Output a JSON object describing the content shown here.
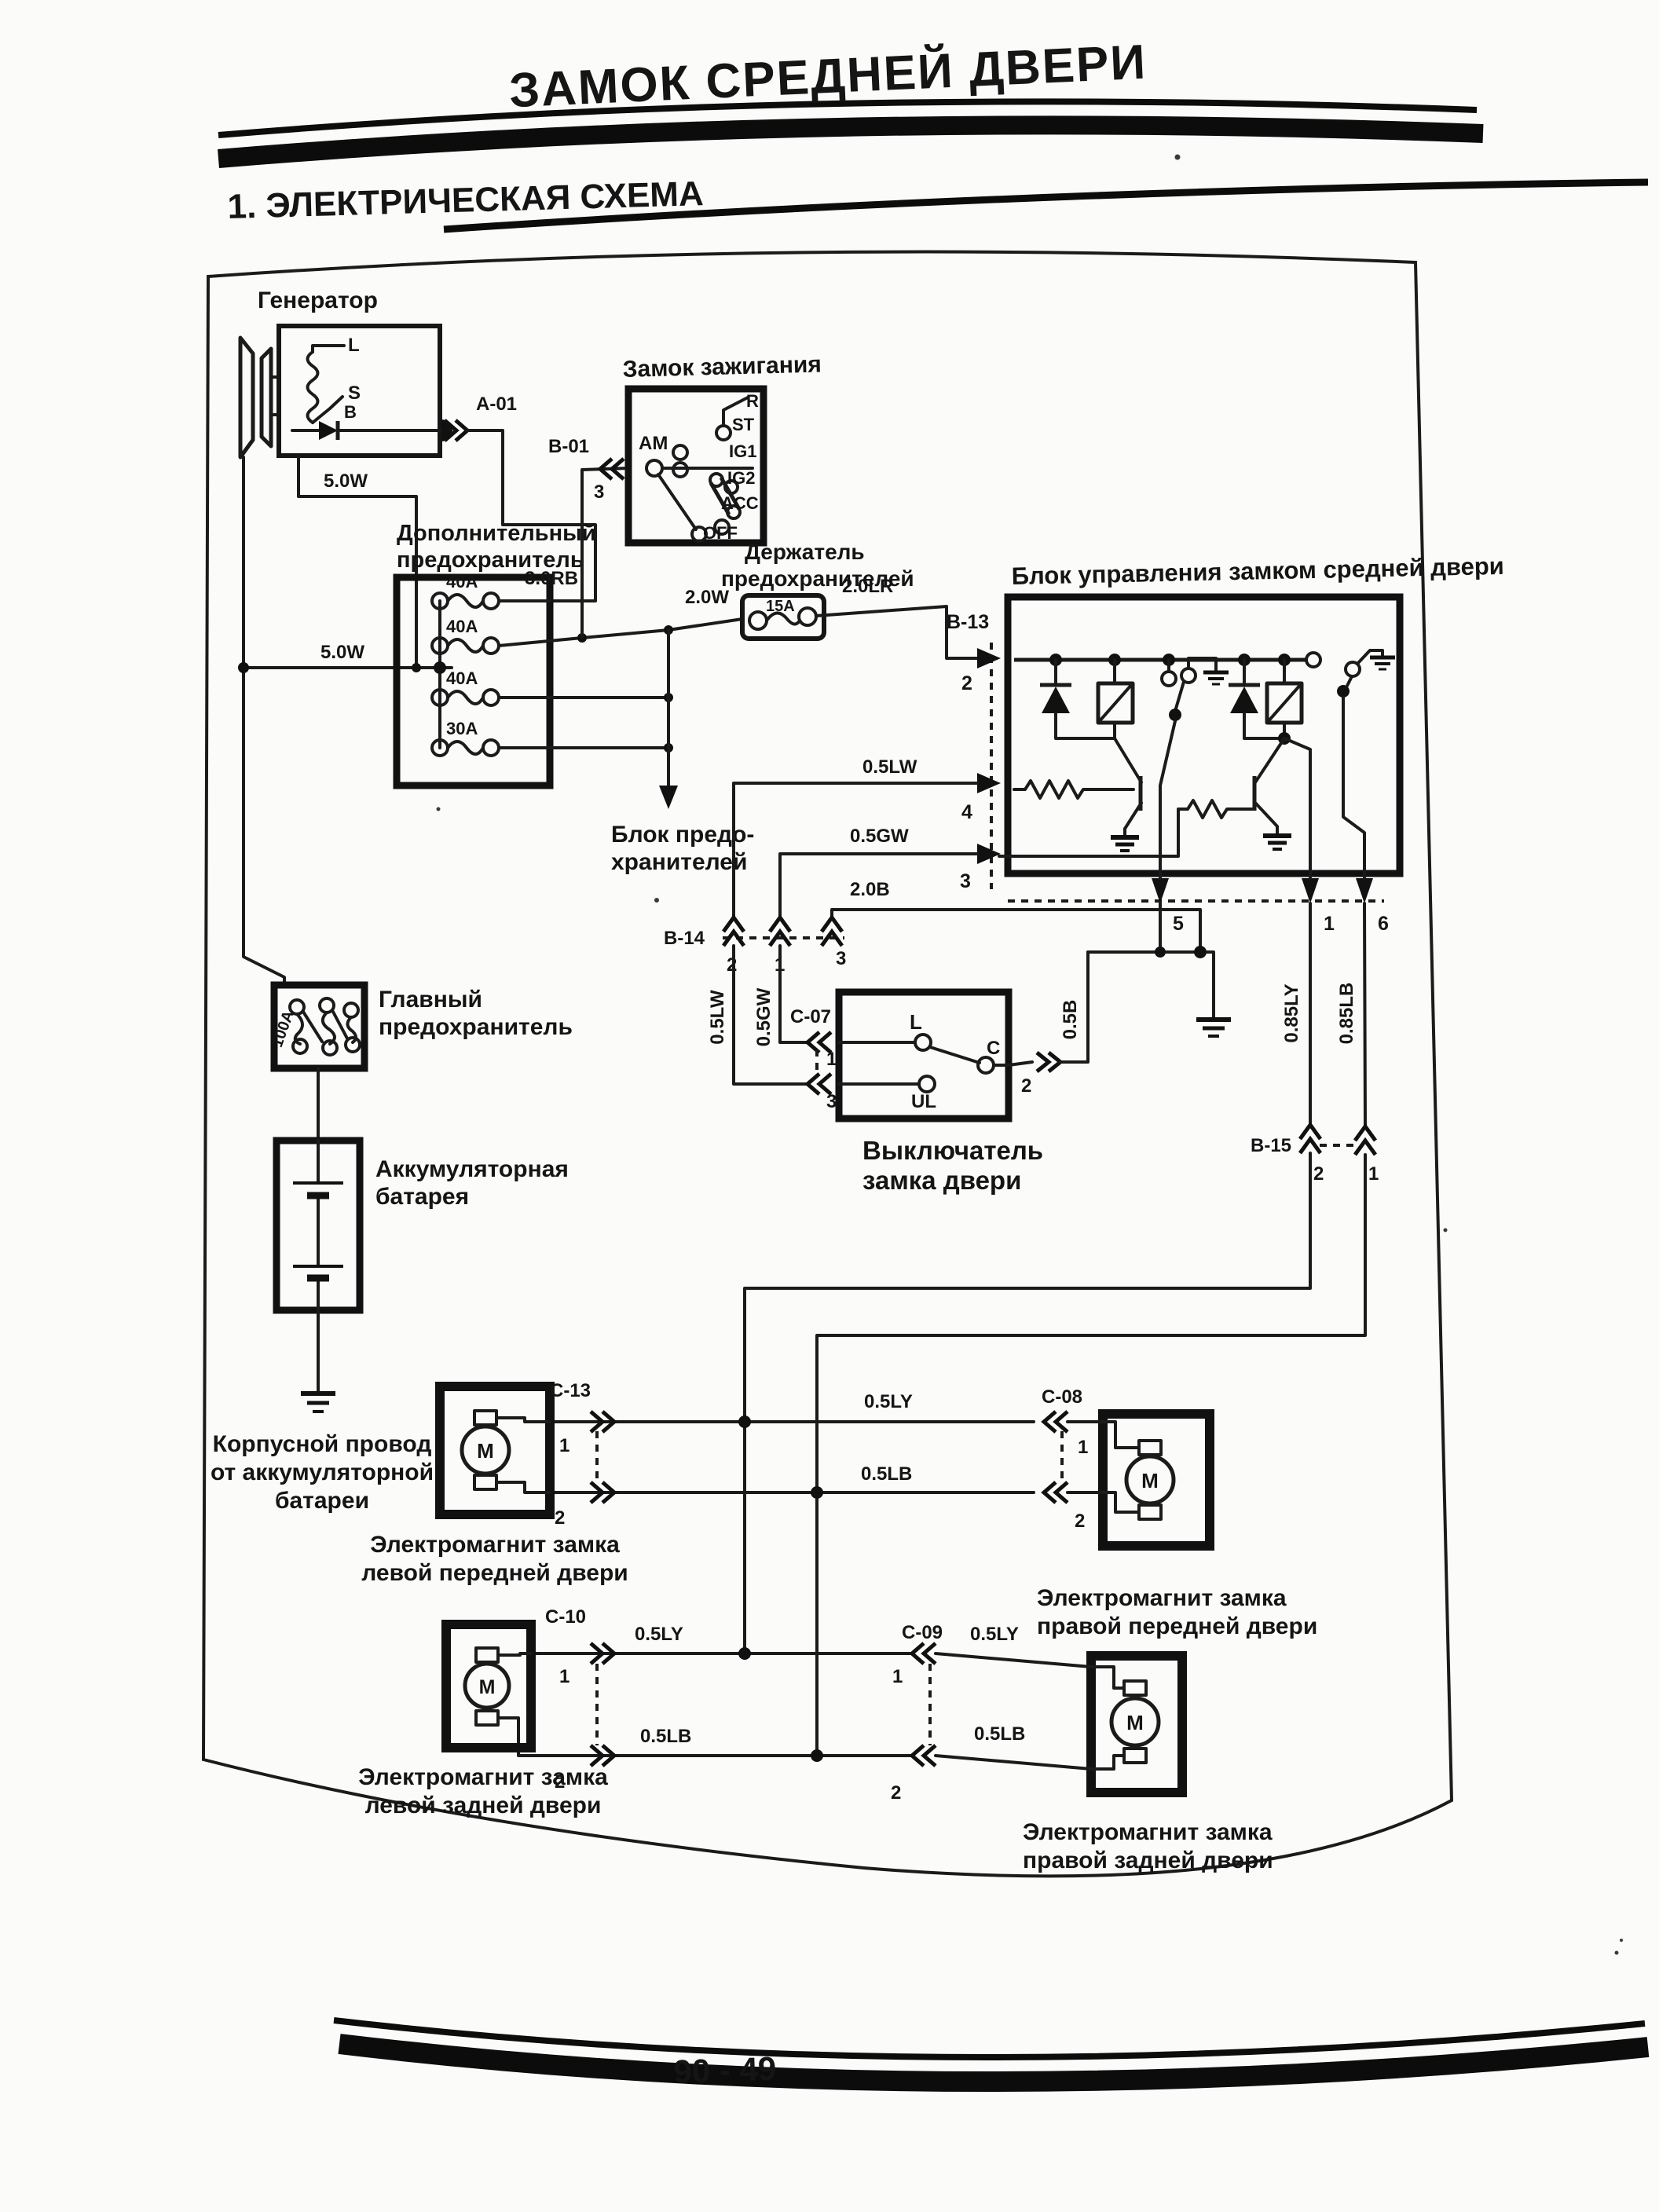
{
  "page": {
    "title": "ЗАМОК СРЕДНЕЙ ДВЕРИ",
    "section_heading": "1. ЭЛЕКТРИЧЕСКАЯ СХЕМА",
    "page_number": "90 - 49"
  },
  "wires": {
    "w50": "5.0W",
    "w30rb": "3.0RB",
    "w20w": "2.0W",
    "w20lr": "2.0LR",
    "w05lw": "0.5LW",
    "w05gw": "0.5GW",
    "w20b": "2.0B",
    "w05b": "0.5B",
    "w085ly": "0.85LY",
    "w085lb": "0.85LB",
    "w05ly": "0.5LY",
    "w05lb": "0.5LB"
  },
  "generator": {
    "label": "Генератор",
    "t_l": "L",
    "t_s": "S",
    "t_b": "B"
  },
  "ignition": {
    "label": "Замок зажигания",
    "am": "AM",
    "r": "R",
    "st": "ST",
    "ig1": "IG1",
    "ig2": "IG2",
    "acc": "ACC",
    "off": "OFF"
  },
  "add_fuse": {
    "line1": "Дополнительный",
    "line2": "предохранитель",
    "f1": "40A",
    "f2": "40A",
    "f3": "40A",
    "f4": "30A"
  },
  "fuse_holder": {
    "line1": "Держатель",
    "line2": "предохранителей",
    "rating": "15A"
  },
  "fuse_block": {
    "line1": "Блок предо-",
    "line2": "хранителей"
  },
  "control_unit": {
    "label": "Блок управления замком средней двери"
  },
  "main_fuse": {
    "line1": "Главный",
    "line2": "предохранитель",
    "rating": "100A"
  },
  "battery": {
    "line1": "Аккумуляторная",
    "line2": "батарея"
  },
  "body_ground": {
    "line1": "Корпусной провод",
    "line2": "от аккумуляторной",
    "line3": "батареи"
  },
  "door_switch": {
    "line1": "Выключатель",
    "line2": "замка двери",
    "t_l": "L",
    "t_c": "C",
    "t_ul": "UL"
  },
  "solenoids": {
    "motor": "M",
    "lf": {
      "line1": "Электромагнит замка",
      "line2": "левой передней двери"
    },
    "rf": {
      "line1": "Электромагнит замка",
      "line2": "правой передней двери"
    },
    "lr": {
      "line1": "Электромагнит замка",
      "line2": "левой задней двери"
    },
    "rr": {
      "line1": "Электромагнит замка",
      "line2": "правой задней двери"
    }
  },
  "connectors": {
    "a01": {
      "label": "A-01"
    },
    "b01": {
      "label": "B-01",
      "p3": "3"
    },
    "b13": {
      "label": "B-13",
      "p2": "2",
      "p4": "4",
      "p3": "3",
      "p5": "5",
      "p1": "1",
      "p6": "6"
    },
    "b14": {
      "label": "B-14",
      "p2": "2",
      "p1": "1",
      "p3": "3"
    },
    "b15": {
      "label": "B-15",
      "p2": "2",
      "p1": "1"
    },
    "c07": {
      "label": "C-07",
      "p1": "1",
      "p3": "3",
      "p2": "2"
    },
    "c13": {
      "label": "C-13",
      "p1": "1",
      "p2": "2"
    },
    "c08": {
      "label": "C-08",
      "p1": "1",
      "p2": "2"
    },
    "c10": {
      "label": "C-10",
      "p1": "1",
      "p2": "2"
    },
    "c09": {
      "label": "C-09",
      "p1": "1",
      "p2": "2"
    }
  }
}
